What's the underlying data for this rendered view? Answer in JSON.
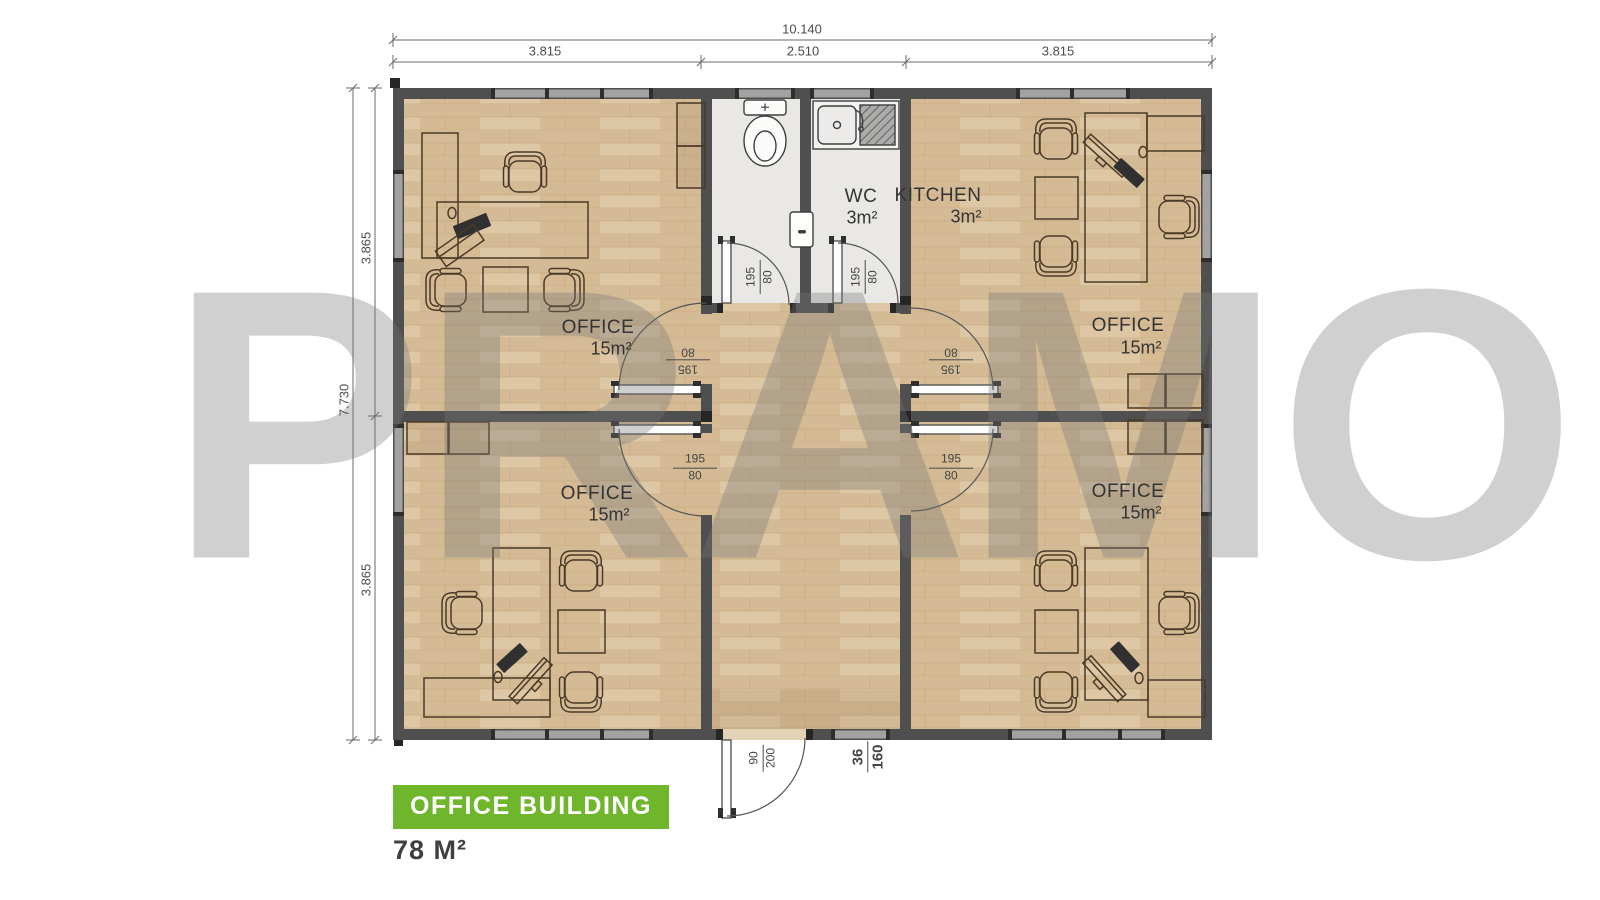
{
  "watermark": {
    "text": "PRAMO"
  },
  "title_block": {
    "label": "OFFICE BUILDING",
    "area": "78 M²",
    "accent_color": "#70b62c"
  },
  "dimensions": {
    "top_total": "10.140",
    "top_segments": [
      "3.815",
      "2.510",
      "3.815"
    ],
    "left_total": "7.730",
    "left_segments": [
      "3.865",
      "3.865"
    ]
  },
  "rooms": {
    "office_top_left": {
      "name": "OFFICE",
      "area": "15m²"
    },
    "office_top_right": {
      "name": "OFFICE",
      "area": "15m²"
    },
    "office_bottom_left": {
      "name": "OFFICE",
      "area": "15m²"
    },
    "office_bottom_right": {
      "name": "OFFICE",
      "area": "15m²"
    },
    "wc": {
      "name": "WC",
      "area": "3m²"
    },
    "kitchen": {
      "name": "KITCHEN",
      "area": "3m²"
    }
  },
  "openings": {
    "wc_door": {
      "top": "195",
      "bottom": "80"
    },
    "kitchen_door": {
      "top": "195",
      "bottom": "80"
    },
    "office_tl_door": {
      "top": "195",
      "bottom": "80"
    },
    "office_tr_door": {
      "top": "195",
      "bottom": "80"
    },
    "office_bl_door": {
      "top": "195",
      "bottom": "80"
    },
    "office_br_door": {
      "top": "195",
      "bottom": "80"
    },
    "entrance_door": {
      "top": "90",
      "bottom": "200"
    },
    "bottom_window": {
      "top": "36",
      "bottom": "160"
    }
  }
}
